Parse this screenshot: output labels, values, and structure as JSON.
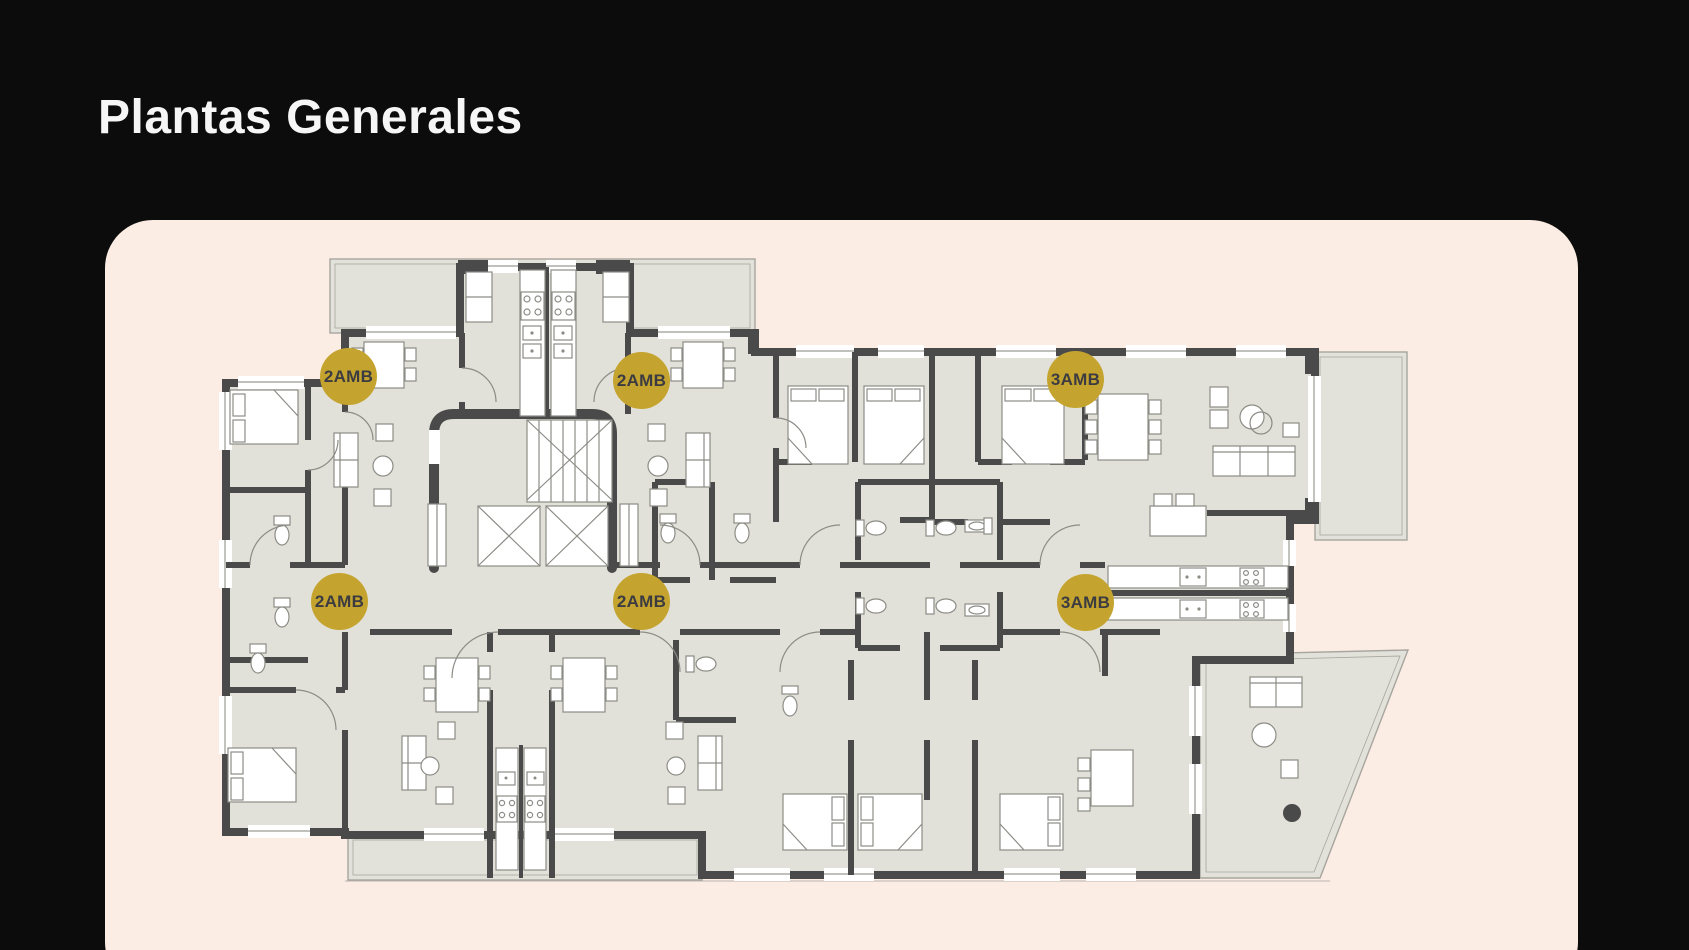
{
  "page": {
    "title": "Plantas Generales"
  },
  "theme": {
    "background": "#0C0C0C",
    "card_background": "#FBECE4",
    "accent_gold": "#C4A42F",
    "badge_text_color": "#3B3B41",
    "floor_fill": "#E2E1D9",
    "wall_color": "#4A4A4A",
    "title_color": "#F6F6F6"
  },
  "floor_plan": {
    "description": "building-floor-plan",
    "badges": [
      {
        "label": "2AMB"
      },
      {
        "label": "2AMB"
      },
      {
        "label": "3AMB"
      },
      {
        "label": "2AMB"
      },
      {
        "label": "2AMB"
      },
      {
        "label": "3AMB"
      }
    ]
  }
}
